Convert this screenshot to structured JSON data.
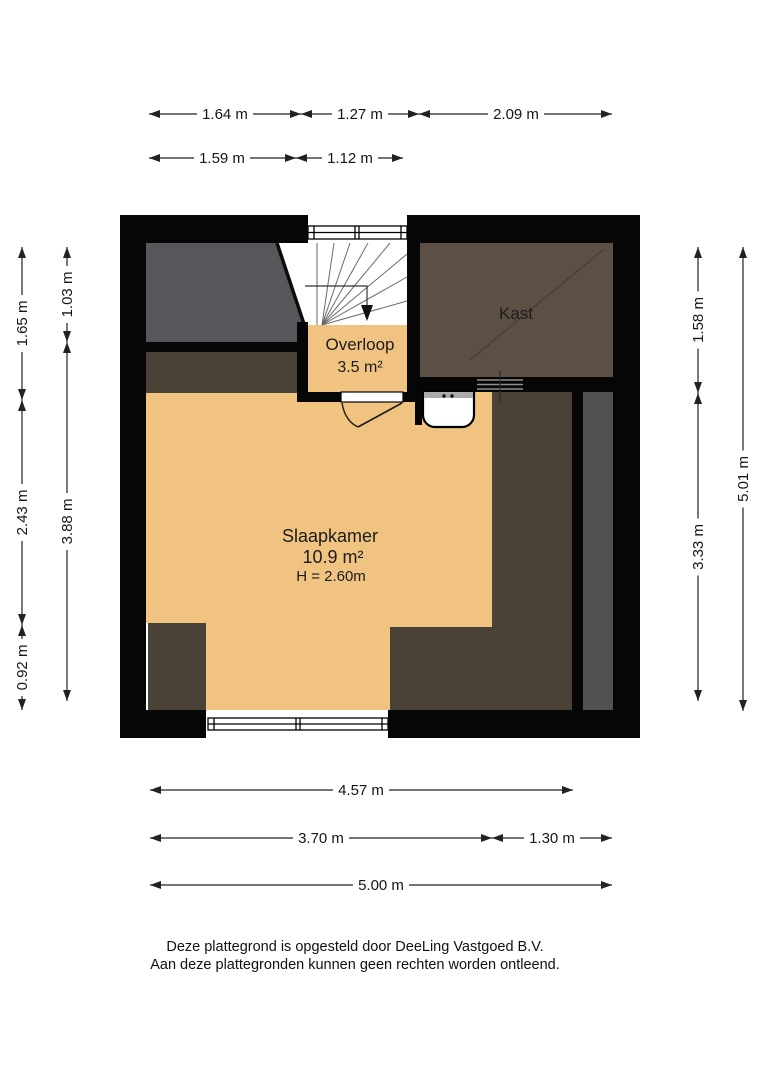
{
  "floorplan": {
    "rooms": {
      "overloop": {
        "name": "Overloop",
        "area": "3.5 m²"
      },
      "kast": {
        "name": "Kast"
      },
      "slaapkamer": {
        "name": "Slaapkamer",
        "area": "10.9 m²",
        "ceiling_height": "H = 2.60m"
      }
    },
    "dimensions": {
      "top_row1": [
        "1.64 m",
        "1.27 m",
        "2.09 m"
      ],
      "top_row2": [
        "1.59 m",
        "1.12 m"
      ],
      "left_outer": [
        "1.65 m",
        "2.43 m",
        "0.92 m"
      ],
      "left_inner": [
        "1.03 m",
        "3.88 m"
      ],
      "right_inner": [
        "1.58 m",
        "3.33 m"
      ],
      "right_outer": [
        "5.01 m"
      ],
      "bottom_row1": [
        "4.57 m"
      ],
      "bottom_row2": [
        "3.70 m",
        "1.30 m"
      ],
      "bottom_row3": [
        "5.00 m"
      ]
    },
    "colors": {
      "wall": "#060606",
      "floor_orange": "#f0c381",
      "attic_gray": "#59565b",
      "low_headroom_brown": "#4b4237",
      "kast_brown": "#5c5045",
      "shaft_gray": "#535051"
    }
  },
  "footer": {
    "line1": "Deze plattegrond is opgesteld door DeeLing Vastgoed B.V.",
    "line2": "Aan deze plattegronden kunnen geen rechten worden ontleend."
  }
}
